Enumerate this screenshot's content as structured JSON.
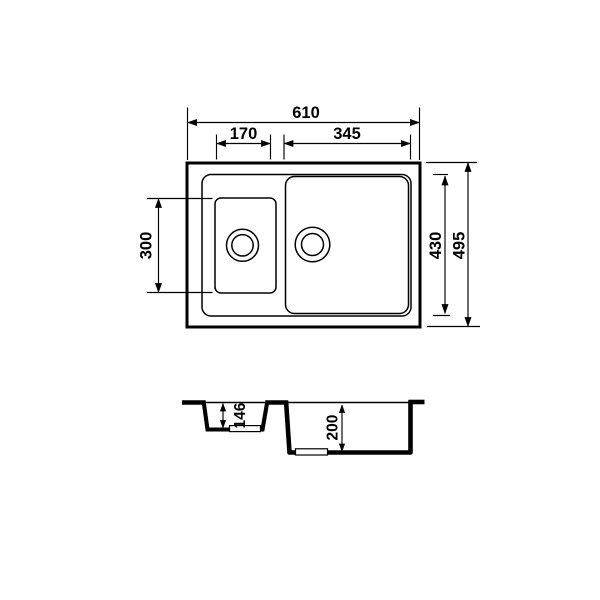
{
  "colors": {
    "line": "#000000",
    "background": "#ffffff"
  },
  "top_view": {
    "overall_width": "610",
    "small_bowl_width": "170",
    "main_bowl_width": "345",
    "small_bowl_length": "300",
    "bowls_length": "430",
    "overall_length": "495"
  },
  "section_view": {
    "small_bowl_depth": "146",
    "main_bowl_depth": "200"
  }
}
